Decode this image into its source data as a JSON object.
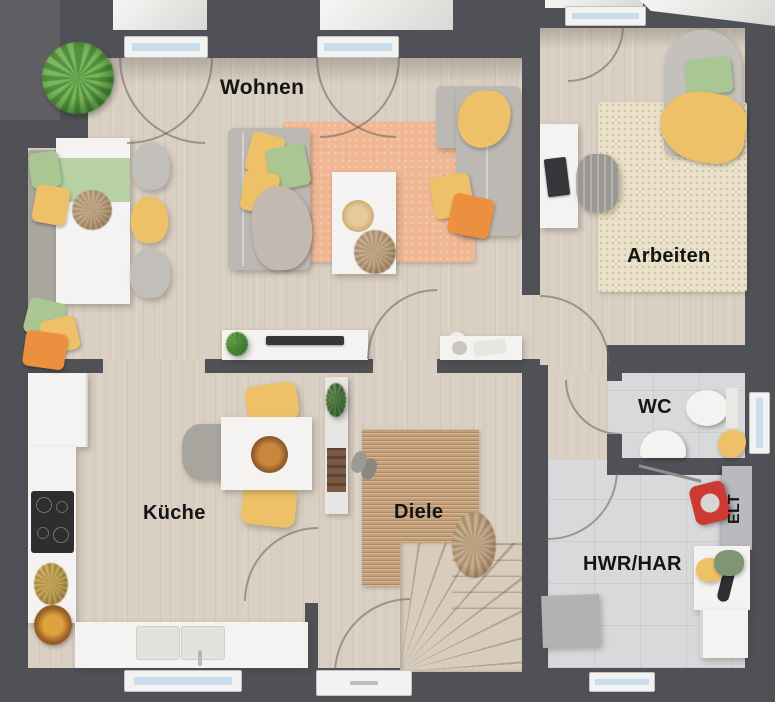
{
  "floorplan": {
    "rooms": {
      "living": {
        "label": "Wohnen"
      },
      "office": {
        "label": "Arbeiten"
      },
      "kitchen": {
        "label": "Küche"
      },
      "hallway": {
        "label": "Diele"
      },
      "wc": {
        "label": "WC"
      },
      "utility": {
        "label": "HWR/HAR"
      },
      "electrical": {
        "label": "ELT"
      }
    },
    "colors": {
      "wall": "#505156",
      "exterior": "#5f5f64",
      "wood": "#d9cfc3",
      "tile": "#d8d9db",
      "white": "#f4f3f1",
      "sofa": "#bcb9b5",
      "ruglive": "#efb793",
      "rugoffice": "#eae1c8",
      "rughall": "#c49e76",
      "yellow": "#eec169",
      "green": "#a9c693",
      "orange": "#ec8f3e",
      "red": "#cc3a33",
      "glass": "#cadded"
    }
  }
}
